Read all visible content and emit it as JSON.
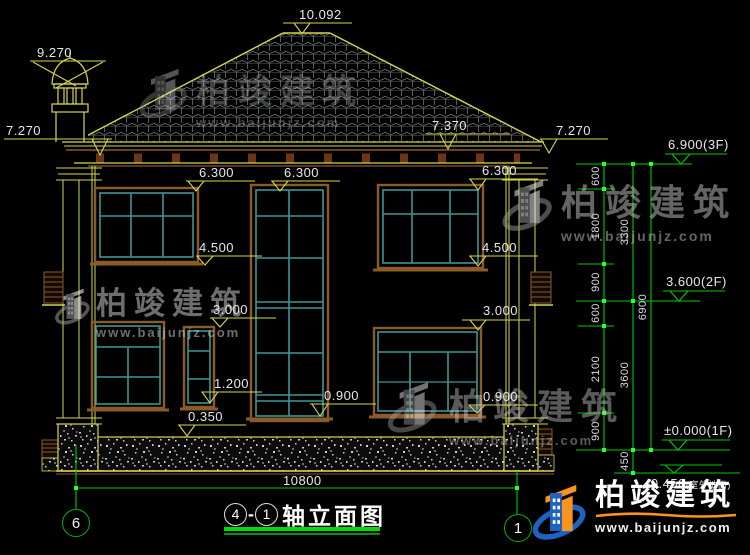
{
  "brand": {
    "name": "柏竣建筑",
    "url": "www.baijunjz.com"
  },
  "markers": {
    "ridge": "10.092",
    "chimney": "9.270",
    "eave_left": "7.270",
    "slope_right": "7.370",
    "eave_right": "7.270",
    "head2_left": "6.300",
    "head2_center": "6.300",
    "head2_right": "6.300",
    "sill2_left": "4.500",
    "sill2_right": "4.500",
    "head1_left": "3.000",
    "head1_right": "3.000",
    "sill1_small": "1.200",
    "plinth_top": "0.350",
    "sill1_center": "0.900",
    "sill1_right": "0.900"
  },
  "levels": {
    "f3": "6.900(3F)",
    "f2": "3.600(2F)",
    "f1": "±0.000(1F)",
    "ground": "-0.450",
    "ground_note": "(室外地面)"
  },
  "chains": {
    "inner": [
      "600",
      "1800",
      "900",
      "600",
      "2100",
      "900"
    ],
    "middle": [
      "3300",
      "3600",
      "450"
    ],
    "outer": [
      "6900"
    ]
  },
  "bottom": {
    "total_width": "10800",
    "bubble_left": "6",
    "bubble_right": "1"
  },
  "title": {
    "axis_a": "4",
    "dash": "-",
    "axis_b": "1",
    "text": "轴立面图"
  },
  "colors": {
    "background": "#000000",
    "line_yellow": "#d6d64f",
    "line_green": "#00c800",
    "window_teal": "#3f9595",
    "trim_brown": "#8a5a28",
    "text": "#e8e8e8",
    "logo_blue": "#1c63c4",
    "logo_orange": "#f7941d"
  }
}
